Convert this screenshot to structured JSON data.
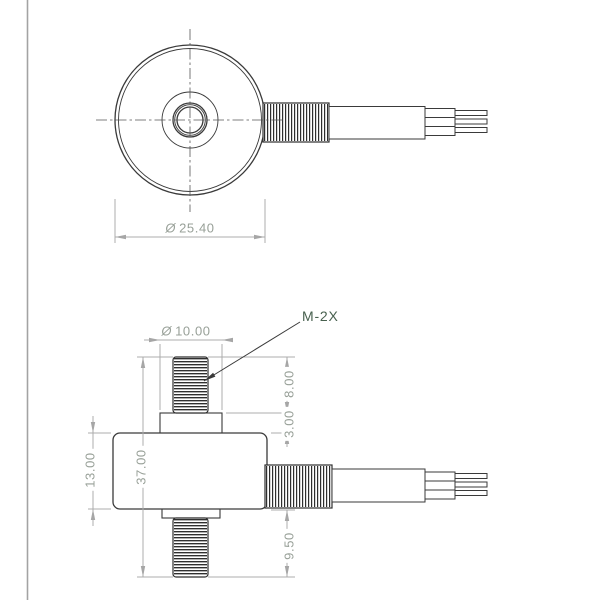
{
  "drawing": {
    "dims": {
      "outer_diameter": {
        "symbol": "Ø",
        "value": "25.40"
      },
      "boss_diameter": {
        "symbol": "Ø",
        "value": "10.00"
      },
      "stud_top_length": {
        "value": "8.00"
      },
      "boss_height": {
        "value": "3.00"
      },
      "overall_height": {
        "value": "37.00"
      },
      "body_height": {
        "value": "13.00"
      },
      "stud_bottom_length": {
        "value": "9.50"
      }
    },
    "callouts": {
      "thread": "M-2X"
    },
    "colors": {
      "background": "#ffffff",
      "sheet_border": "#a3a3a3",
      "part_line": "#3a3a3a",
      "thread_line": "#2f2f2f",
      "dimension_line": "#acacac",
      "dimension_text": "#98a098",
      "callout_text": "#48614f",
      "centerline": "#565656"
    }
  }
}
